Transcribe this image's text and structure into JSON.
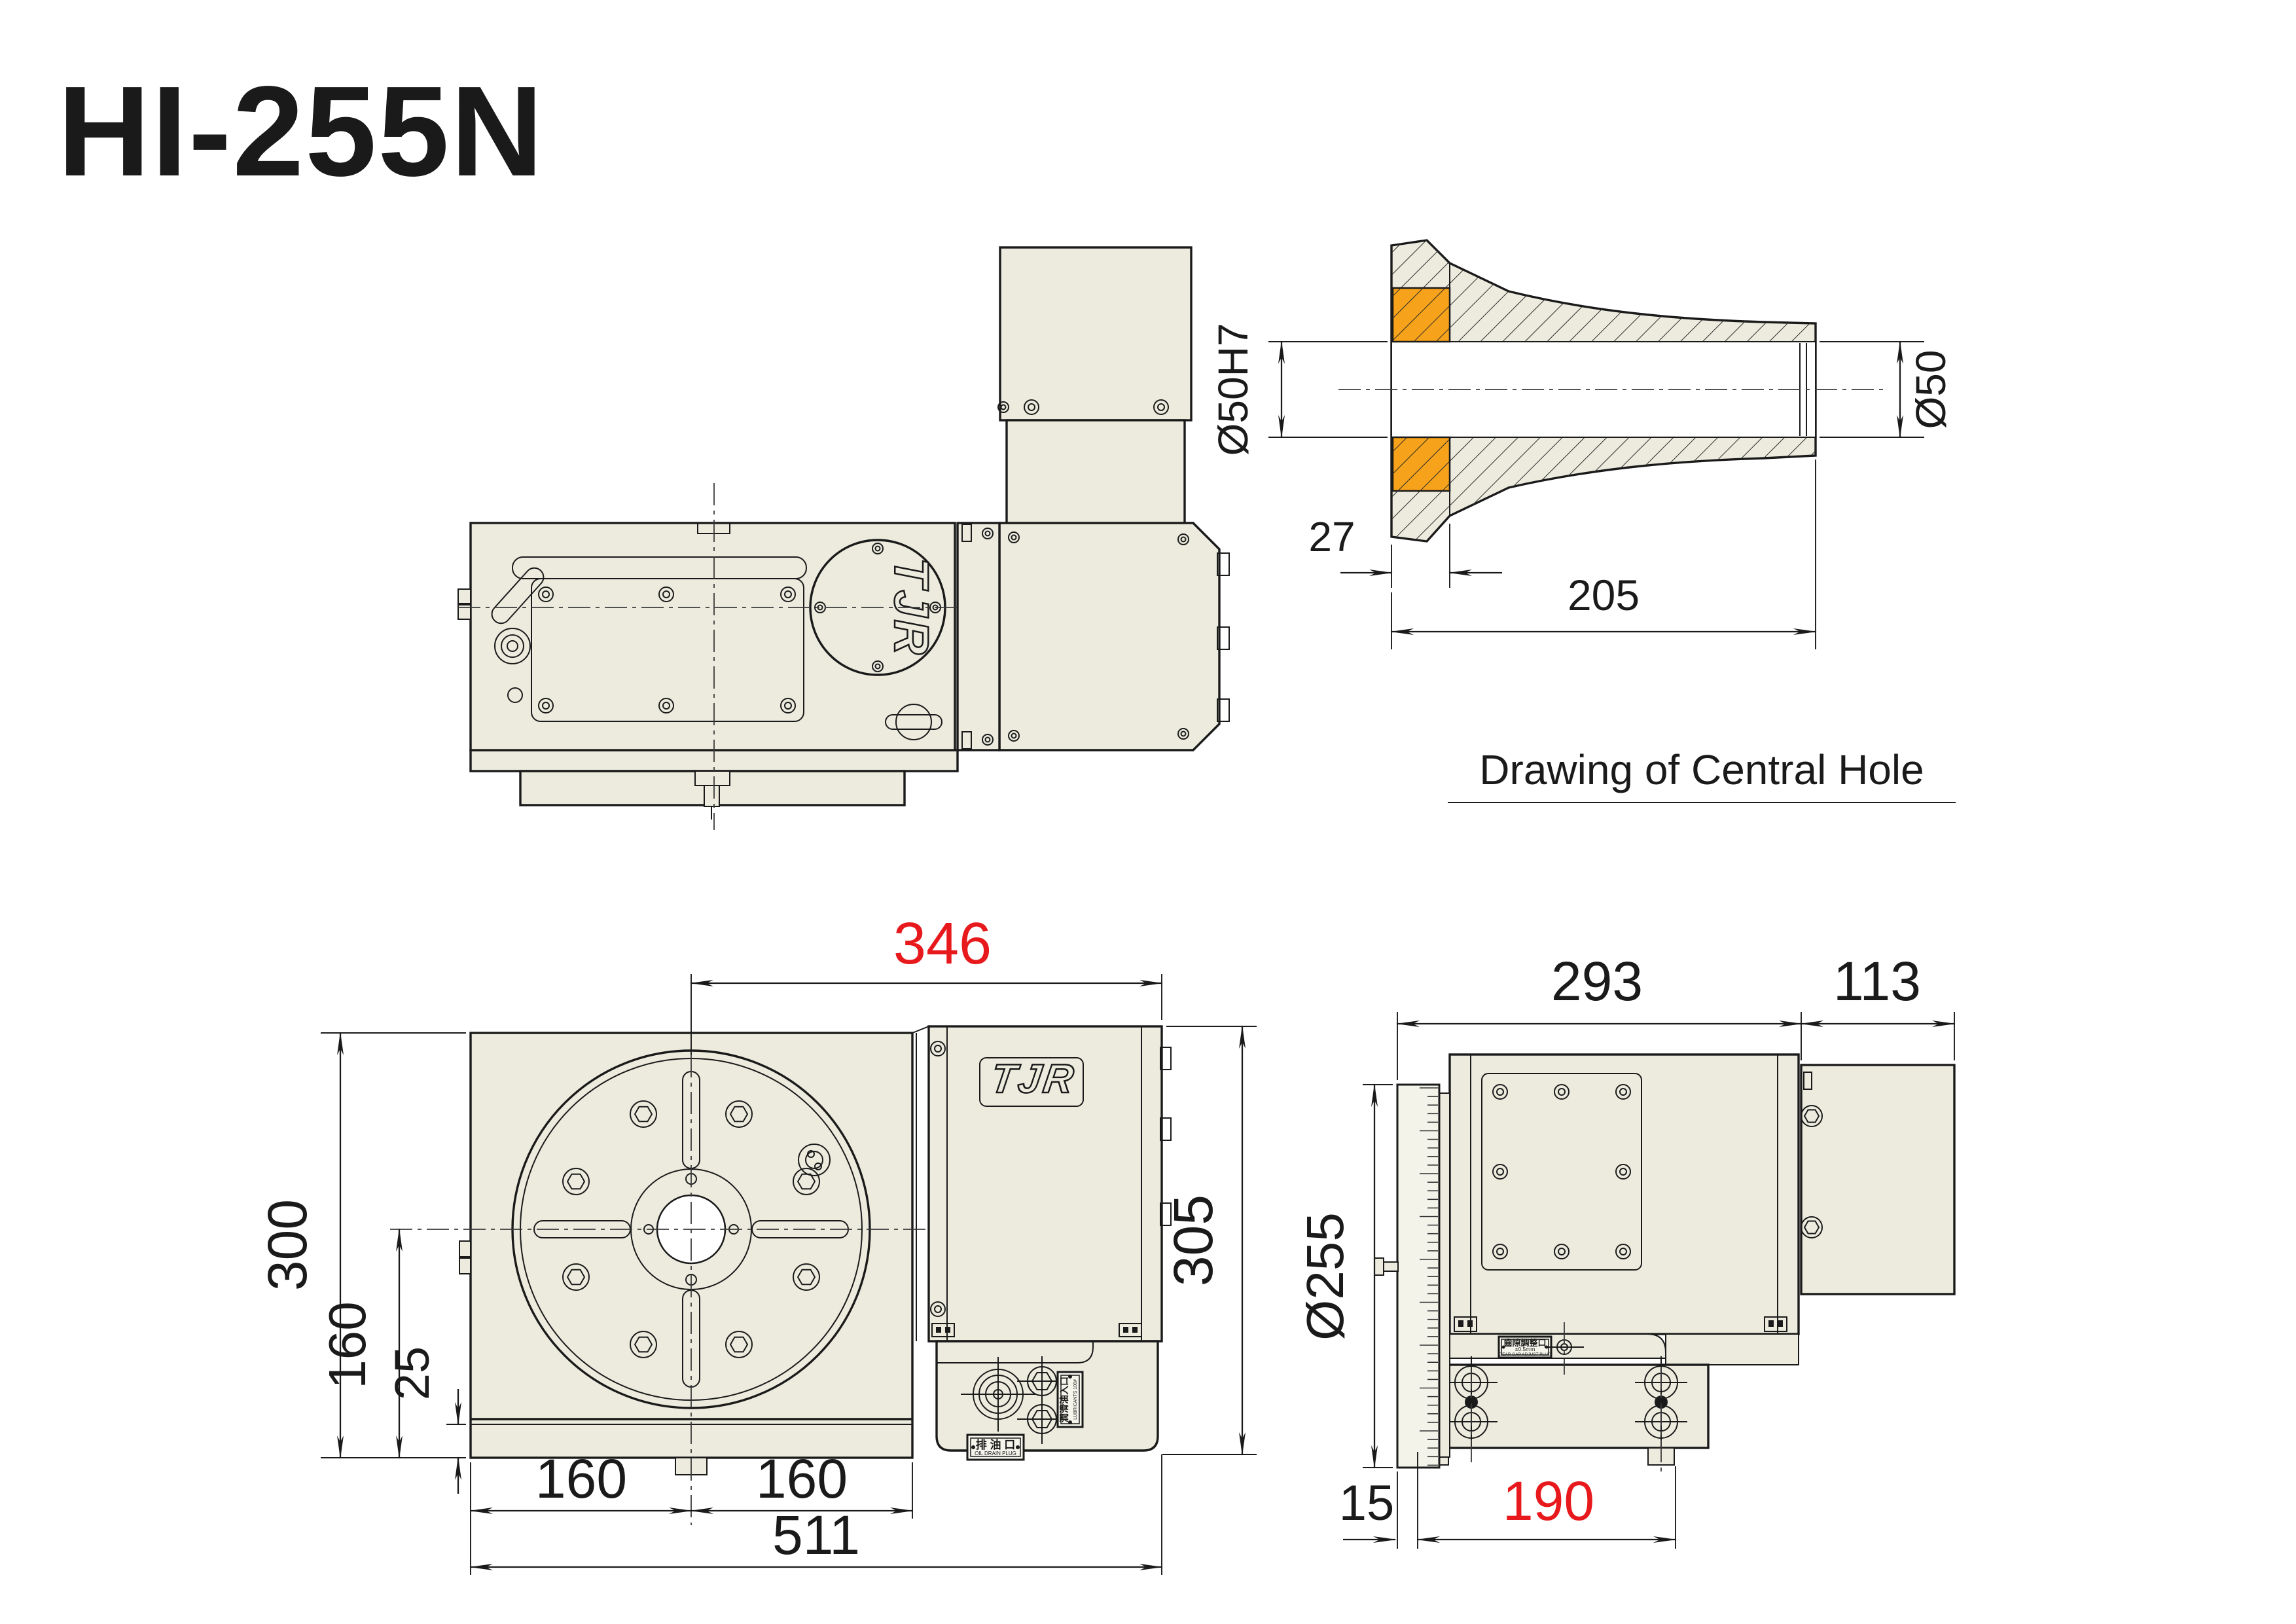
{
  "title": "HI-255N",
  "colors": {
    "body_fill": "#ECEBDE",
    "line": "#1a1a1a",
    "dimension_red": "#E8191C",
    "highlight_orange": "#F7A21B"
  },
  "central_hole": {
    "caption": "Drawing of Central Hole",
    "dim_bore_tolerance": "Ø50H7",
    "dim_bore": "Ø50",
    "dim_flange_depth": "27",
    "dim_total_length": "205"
  },
  "top_view": {
    "logo": "TJR"
  },
  "front_view": {
    "logo": "TJR",
    "dim_center_to_right": "346",
    "dim_height": "300",
    "dim_center_to_base": "160",
    "dim_strip": "25",
    "dim_bolt_left": "160",
    "dim_bolt_right": "160",
    "dim_total_width": "511",
    "dim_height_right": "305",
    "plate_oil_drain_cn": "排 油 口",
    "plate_oil_drain_en": "OIL DRAIN PLUG",
    "plate_lubricant_cn": "潤滑油入口",
    "plate_lubricant_en": "LUBRICANTS 100#"
  },
  "side_view": {
    "dim_body_depth": "293",
    "dim_motor_depth": "113",
    "dim_table_dia": "Ø255",
    "dim_base_offset": "15",
    "dim_base_depth": "190",
    "plate_gear_cn": "齒隙調整口",
    "plate_gear_tol": "±0.5mm",
    "plate_gear_en": "GEAR GAP ADJUST PLUG"
  }
}
